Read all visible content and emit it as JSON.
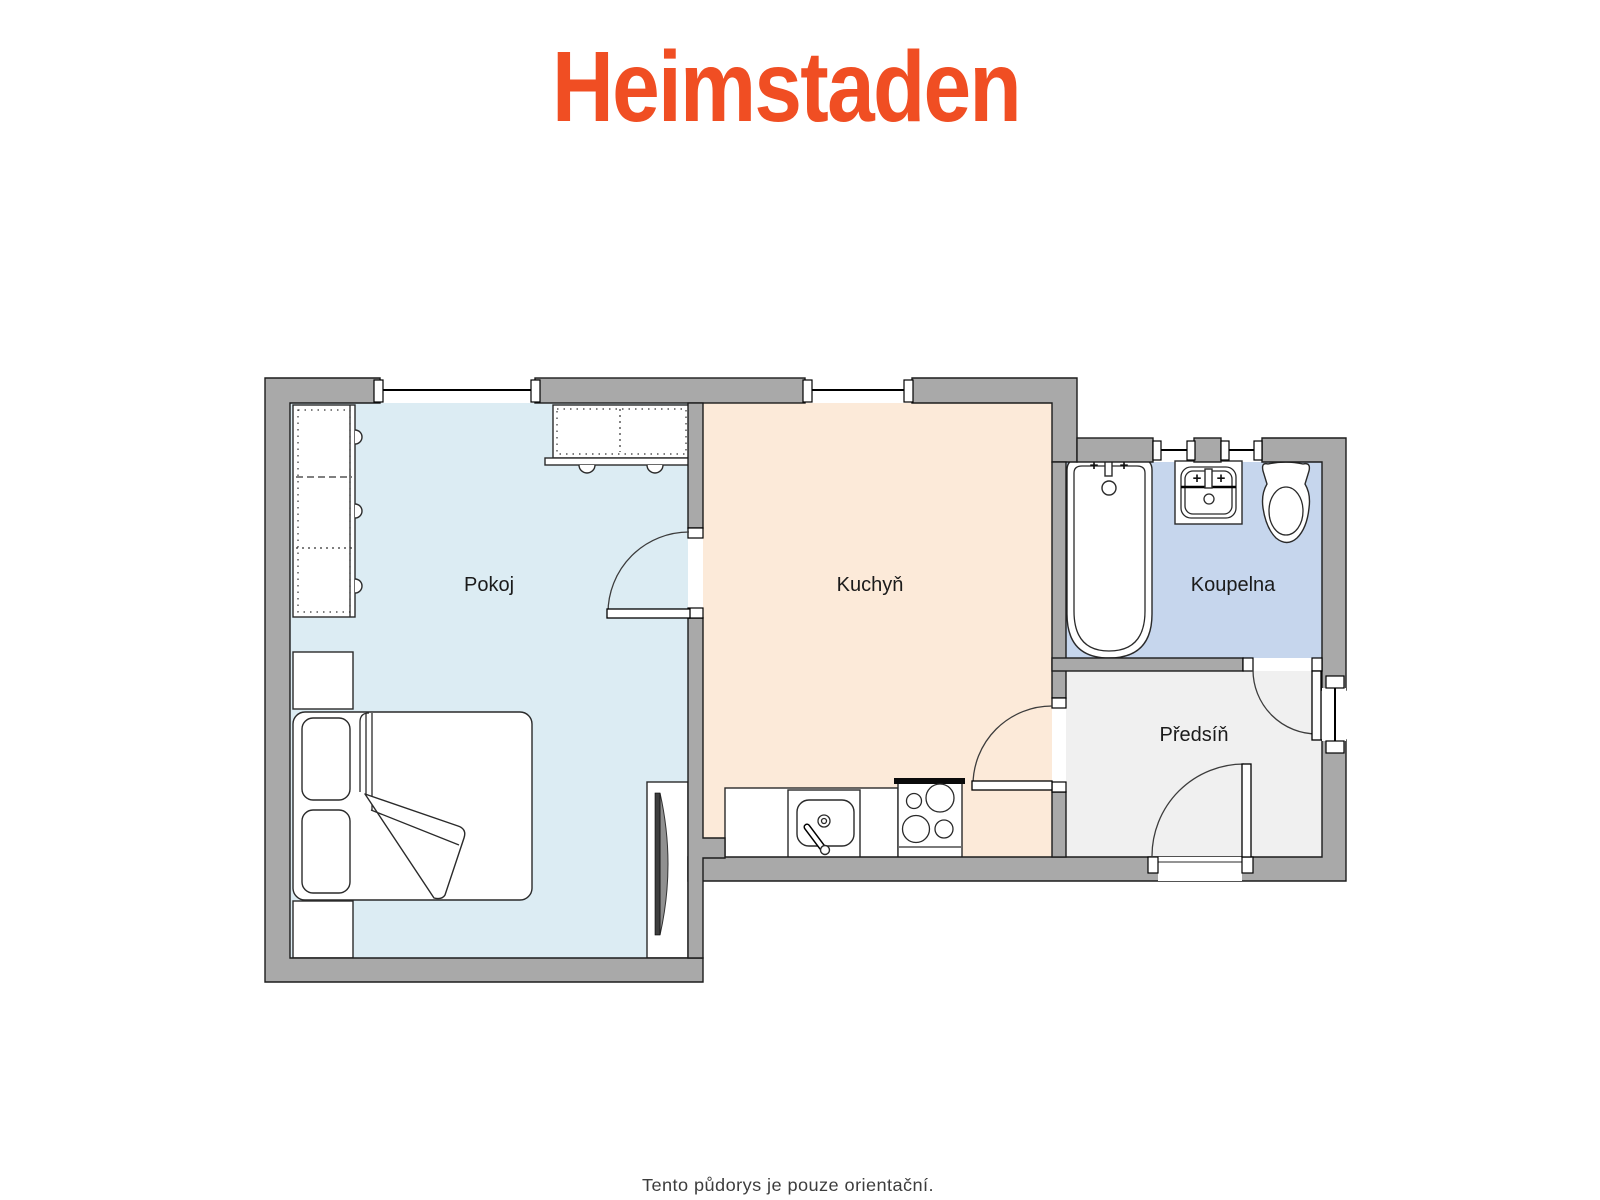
{
  "brand": {
    "logo_text": "Heimstaden",
    "logo_color": "#F04E23"
  },
  "footer": {
    "disclaimer": "Tento půdorys je pouze orientační."
  },
  "floorplan": {
    "wall_color": "#a9a9a9",
    "rooms": [
      {
        "id": "pokoj",
        "label": "Pokoj",
        "floor_color": "#dcecf3"
      },
      {
        "id": "kuchyn",
        "label": "Kuchyň",
        "floor_color": "#fcead9"
      },
      {
        "id": "koupelna",
        "label": "Koupelna",
        "floor_color": "#c6d6ed"
      },
      {
        "id": "predsin",
        "label": "Předsíň",
        "floor_color": "#f0f0f0"
      }
    ],
    "fixtures": {
      "pokoj": [
        "wardrobe",
        "tall-wardrobe",
        "double-bed",
        "nightstands",
        "tv"
      ],
      "kuchyn": [
        "kitchen-counter",
        "kitchen-sink",
        "stove"
      ],
      "koupelna": [
        "bathtub",
        "washbasin",
        "toilet"
      ]
    },
    "tap_symbol": "+"
  }
}
